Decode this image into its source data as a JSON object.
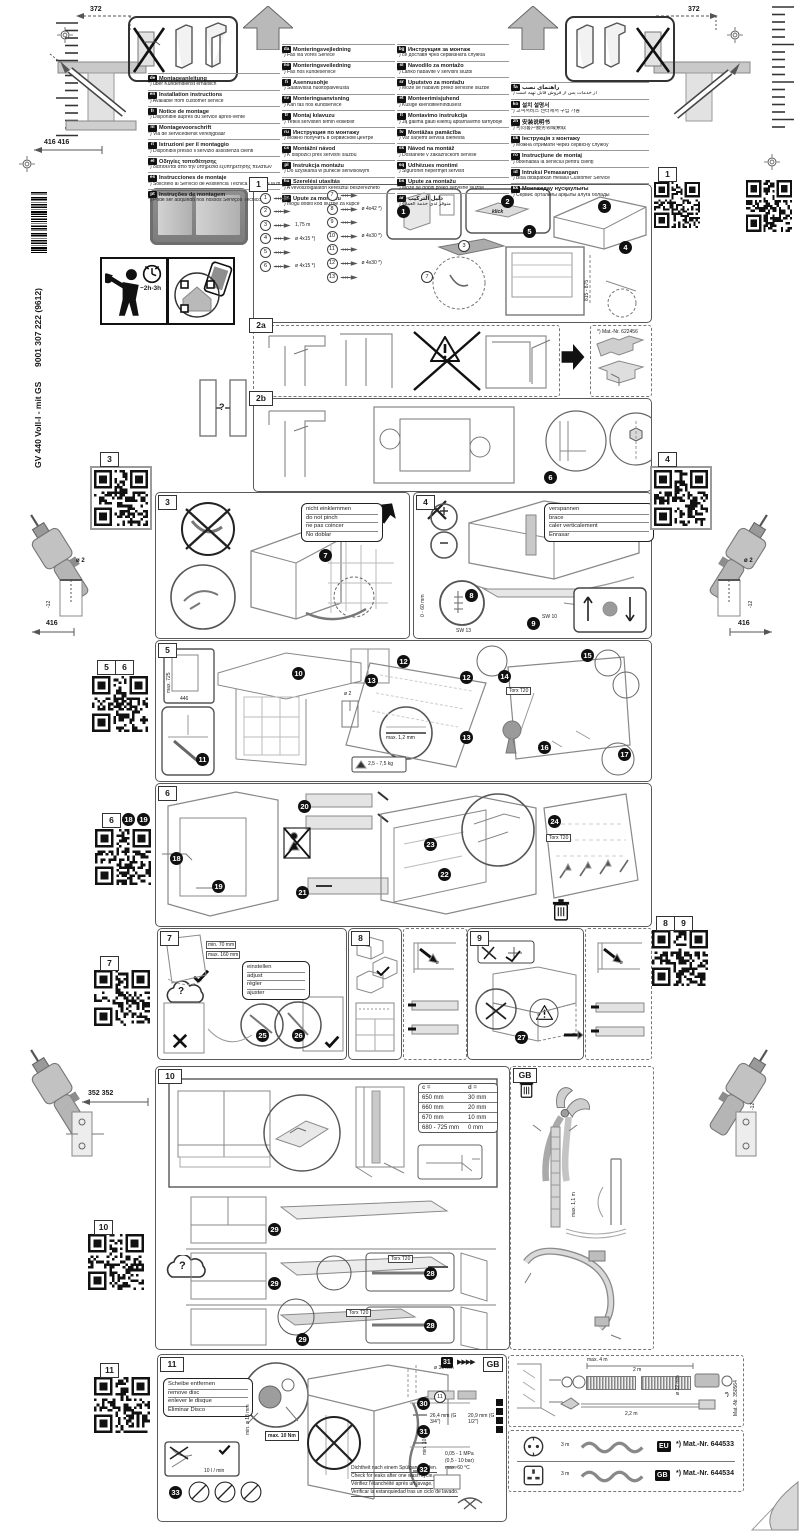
{
  "sidebar": {
    "doc_number": "9001 307 222 (9612)",
    "model": "GV 440 Voll-I - mit GS"
  },
  "misc": {
    "q": "?",
    "klick": "klick",
    "time": "~2h-3h",
    "torx": "Torx T20",
    "star": "*)",
    "arrows": "▶▶▶▶"
  },
  "dims": {
    "d372": "372",
    "d416416": "416 416",
    "d416": "416",
    "dm12": "-12",
    "dia2": "ø 2",
    "d352": "352 352",
    "niche": "815 - 875",
    "range060": "0 - 60 mm",
    "sw13": "SW 13",
    "sw10": "SW 10",
    "max725": "max. 725",
    "w446": "446",
    "maxgap": "max. 1,2 mm",
    "weight": "2,5 - 7,5 kg",
    "min70": "min. 70 mm",
    "max160": "max. 160 mm",
    "max11m": "max. 1,1 m",
    "torque": "max. 10 Nm",
    "flow": "10 l / min",
    "min18": "min. ø 18 mm",
    "dia30": "ø 30 mm",
    "g34": "26,4 mm (G 3/4\")",
    "g12": "20,9 mm (G 1/2\")",
    "min10": "min. 10 mm",
    "mpa": "0,05 - 1 MPa",
    "bar": "(0,5 - 10 bar)",
    "temp": "max. 60 °C",
    "max4m": "max. 4 m",
    "m2": "2 m",
    "m22": "2,2 m",
    "dia22": "ø 22 mm",
    "len3m": "3 m"
  },
  "mats": {
    "m622": "*) Mat.-Nr. 622456",
    "m350": "Mat.-Nr. 350564",
    "m533": "*) Mat.-Nr. 644533",
    "m534": "*) Mat.-Nr. 644534"
  },
  "tags": {
    "t1": "1",
    "t2a": "2a",
    "t2b": "2b",
    "t3": "3",
    "t4": "4",
    "t5": "5",
    "t6": "6",
    "t7": "7",
    "t8": "8",
    "t9": "9",
    "t10": "10",
    "t11": "11",
    "gb": "GB",
    "eu": "EU"
  },
  "qr_labels": {
    "q1": "1",
    "q3": "3",
    "q4": "4",
    "q5": "5",
    "q6": "6",
    "q7": "7",
    "q8": "8",
    "q9": "9",
    "q10": "10",
    "q11": "11"
  },
  "badges": {
    "b1": "1",
    "b2": "2",
    "b3": "3",
    "b4": "4",
    "b5": "5",
    "b6": "6",
    "b7": "7",
    "b8": "8",
    "b9": "9",
    "b10": "10",
    "b11": "11",
    "b12": "12",
    "b13": "13",
    "b14": "14",
    "b15": "15",
    "b16": "16",
    "b17": "17",
    "b18": "18",
    "b19": "19",
    "b20": "20",
    "b21": "21",
    "b22": "22",
    "b23": "23",
    "b24": "24",
    "b25": "25",
    "b26": "26",
    "b27": "27",
    "b28": "28",
    "b29": "29",
    "b30": "30",
    "b31": "31",
    "b32": "32",
    "b33": "33"
  },
  "notes": {
    "s3": [
      "nicht einklemmen",
      "do not pinch",
      "ne pas coincer",
      "No doblar"
    ],
    "s4": [
      "verspannen",
      "brace",
      "caler verticalement",
      "Enrasar"
    ],
    "s7": [
      "einstellen",
      "adjust",
      "régler",
      "ajuster"
    ],
    "s11": [
      "Scheibe entfernen",
      "remove disc",
      "enlever le disque",
      "Eliminar Disco"
    ],
    "leak": [
      "Dichtheit nach einem Spülgang prüfen.",
      "Check for leaks after one wash cycle.",
      "Vérifiez l'étanchéité après un lavage.",
      "Verificar la estanquiedad tras un ciclo de lavado."
    ]
  },
  "parts": [
    {
      "n": "1",
      "label": ""
    },
    {
      "n": "2",
      "label": ""
    },
    {
      "n": "3",
      "label": "1,75 m"
    },
    {
      "n": "4",
      "label": "ø 4x15 *)"
    },
    {
      "n": "5",
      "label": ""
    },
    {
      "n": "6",
      "label": "ø 4x15 *)"
    },
    {
      "n": "7",
      "label": ""
    },
    {
      "n": "8",
      "label": "ø 4x42 *)"
    },
    {
      "n": "9",
      "label": ""
    },
    {
      "n": "10",
      "label": "ø 4x30 *)"
    },
    {
      "n": "11",
      "label": ""
    },
    {
      "n": "12",
      "label": "ø 4x30 *)"
    },
    {
      "n": "13",
      "label": ""
    }
  ],
  "table10": {
    "header": [
      "c =",
      "d ="
    ],
    "rows": [
      [
        "650 mm",
        "30 mm"
      ],
      [
        "660 mm",
        "20 mm"
      ],
      [
        "670 mm",
        "10 mm"
      ],
      [
        "680 - 725 mm",
        "0 mm"
      ]
    ]
  },
  "languages": {
    "col1": [
      {
        "code": "de",
        "title": "Montageanleitung",
        "note": "*) über Kundendienst erhältlich"
      },
      {
        "code": "en",
        "title": "Installation instructions",
        "note": "*) Available from customer service"
      },
      {
        "code": "fr",
        "title": "Notice de montage",
        "note": "*) Disponible auprès du service après-vente"
      },
      {
        "code": "nl",
        "title": "Montagevoorschrift",
        "note": "*) Via de servicedienst verkrijgbaar"
      },
      {
        "code": "it",
        "title": "Istruzioni per il montaggio",
        "note": "*) Disponibili presso il servizio assistenza clienti"
      },
      {
        "code": "el",
        "title": "Οδηγίες τοποθέτησης",
        "note": "*) διατίθενται από την υπηρεσία εξυπηρέτησης πελατών"
      },
      {
        "code": "es",
        "title": "Instrucciones de montaje",
        "note": "*) Solicítelo al Servicio de Asistencia Técnica Oficial de la marca"
      },
      {
        "code": "pt",
        "title": "Instruções de montagem",
        "note": "*) Pode ser adquirido nos nossos Serviços Técnicos"
      }
    ],
    "col2": [
      {
        "code": "da",
        "title": "Monteringsvejledning",
        "note": "*) Fås via vores Service"
      },
      {
        "code": "no",
        "title": "Monteringsveiledning",
        "note": "*) Fås hos kundeservice"
      },
      {
        "code": "fi",
        "title": "Asennusohje",
        "note": "*) Saatavissa huoltopalvelusta"
      },
      {
        "code": "sv",
        "title": "Monteringsanvisning",
        "note": "*) Kan fås hos kundservice"
      },
      {
        "code": "tr",
        "title": "Montaj kılavuzu",
        "note": "*) Yetkili servisten temin edilebilir"
      },
      {
        "code": "ru",
        "title": "Инструкция по монтажу",
        "note": "*) Можно получить в сервисном центре"
      },
      {
        "code": "cs",
        "title": "Montážní návod",
        "note": "*) K dispozici přes servisní službu"
      },
      {
        "code": "pl",
        "title": "Instrukcja montażu",
        "note": "*) Do uzyskania w punkcie serwisowym"
      },
      {
        "code": "hu",
        "title": "Szerelési utasítás",
        "note": "*) A vevőszolgálaton keresztül beszerezhető"
      },
      {
        "code": "hr",
        "title": "Upute za montažu",
        "note": "*) mogu dobiti kod službe za kupce"
      }
    ],
    "col3": [
      {
        "code": "bg",
        "title": "Инструкция за монтаж",
        "note": "*) се доставя чрез сервизната служба"
      },
      {
        "code": "sl",
        "title": "Navodilo za montažo",
        "note": "*) Lahko nabavite v servisni službi"
      },
      {
        "code": "sr",
        "title": "Uputstvo za montažu",
        "note": "*) Može se nabaviti preko servisne službe"
      },
      {
        "code": "et",
        "title": "Monteerimisjuhend",
        "note": "*) Küsige klienditeenindusest"
      },
      {
        "code": "lt",
        "title": "Montavimo instrukcija",
        "note": "*) Ją galima gauti klientų aptarnavimo tarnyboje"
      },
      {
        "code": "lv",
        "title": "Montāžas pamācība",
        "note": "*) Var saņemt servisa dienestā"
      },
      {
        "code": "sk",
        "title": "Návod na montáž",
        "note": "*) Dostanete v zákazníckom servise"
      },
      {
        "code": "sq",
        "title": "Udhëzues montimi",
        "note": "*) Sigurohet nëpërmjet servisit"
      },
      {
        "code": "bs",
        "title": "Upute za montažu",
        "note": "*) Može se dobiti preko servisne službe"
      },
      {
        "code": "ar",
        "title": "دليل التركيب",
        "note": "*) متوفر لدى خدمة العملاء"
      }
    ],
    "col4": [
      {
        "code": "fa",
        "title": "راهنمای نصب",
        "note": "*) از خدمات پس از فروش قابل تهیه است"
      },
      {
        "code": "ko",
        "title": "설치 설명서",
        "note": "*) 고객서비스 센터에서 구입 가능"
      },
      {
        "code": "zh",
        "title": "安装说明书",
        "note": "*) 可向客户服务领域索取"
      },
      {
        "code": "uk",
        "title": "Інструкція з монтажу",
        "note": "*) Можна отримати через сервісну службу"
      },
      {
        "code": "ro",
        "title": "Instrucţiune de montaj",
        "note": "*) obtenabilă la serviciul pentru clienţi"
      },
      {
        "code": "id",
        "title": "Intruksi Pemasangan",
        "note": "*) Bisa didapatkan melalui Customer Service"
      },
      {
        "code": "kk",
        "title": "Монтаждау нұсқаулығы",
        "note": "*) Сервис орталығы арқылы алуға болады"
      }
    ]
  }
}
